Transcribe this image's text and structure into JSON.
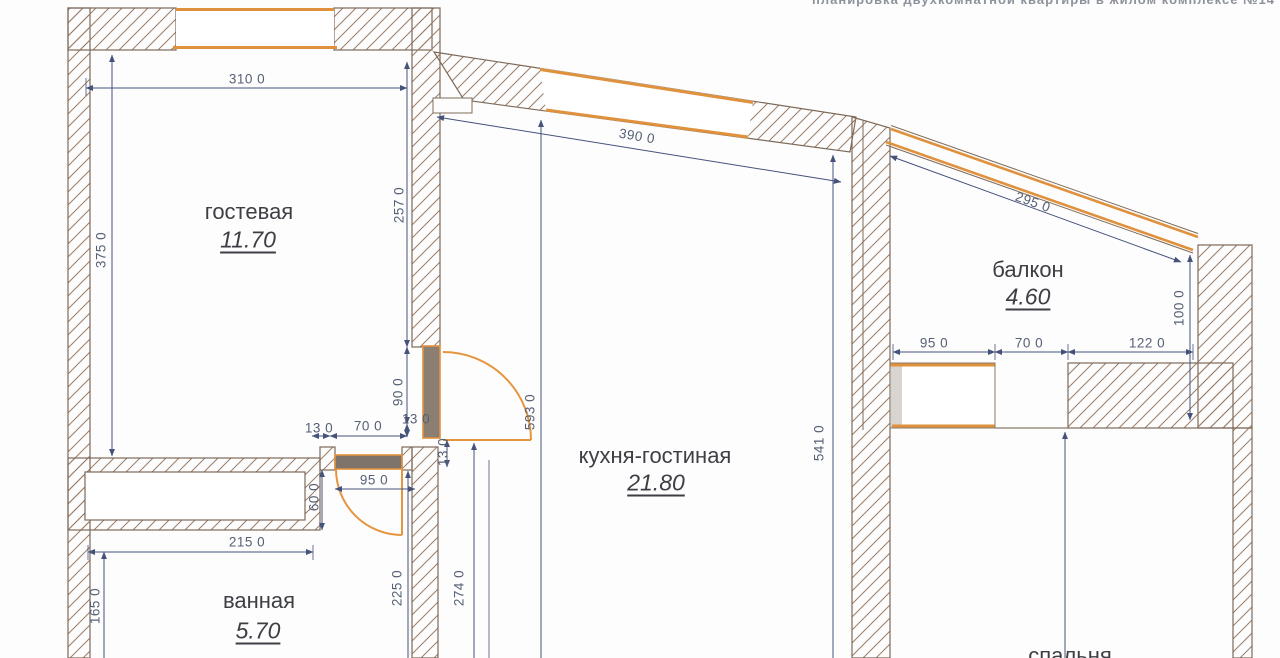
{
  "header": {
    "cropped_text": "планировка двухкомнатной квартиры в жилом комплексе №14"
  },
  "rooms": {
    "guest": {
      "name": "гостевая",
      "area": "11.70"
    },
    "kitchen": {
      "name": "кухня-гостиная",
      "area": "21.80"
    },
    "balcony": {
      "name": "балкон",
      "area": "4.60"
    },
    "bath": {
      "name": "ванная",
      "area": "5.70"
    },
    "bedroom": {
      "name": "спальня"
    }
  },
  "dims": {
    "w310": "310 0",
    "h375": "375 0",
    "h257": "257 0",
    "w390": "390 0",
    "w295": "295 0",
    "h100": "100 0",
    "w95_balcony": "95 0",
    "w70_balcony": "70 0",
    "w122": "122 0",
    "h541": "541 0",
    "h593": "593 0",
    "h90": "90 0",
    "t13_a": "13 0",
    "w70_door": "70 0",
    "t13_b": "13 0",
    "t13_c": "13 0",
    "w95_bathdoor": "95 0",
    "h60": "60 0",
    "w215": "215 0",
    "h165": "165 0",
    "h225": "225 0",
    "h274": "274 0"
  },
  "colors": {
    "wall_hatch": "#9b7c66",
    "wall_outline": "#7d6a59",
    "window_accent": "#e0913d",
    "dimension_line": "#45527a",
    "dimension_text": "#566074",
    "room_text": "#3d3f44",
    "infill_gray": "#d8d4cf"
  }
}
